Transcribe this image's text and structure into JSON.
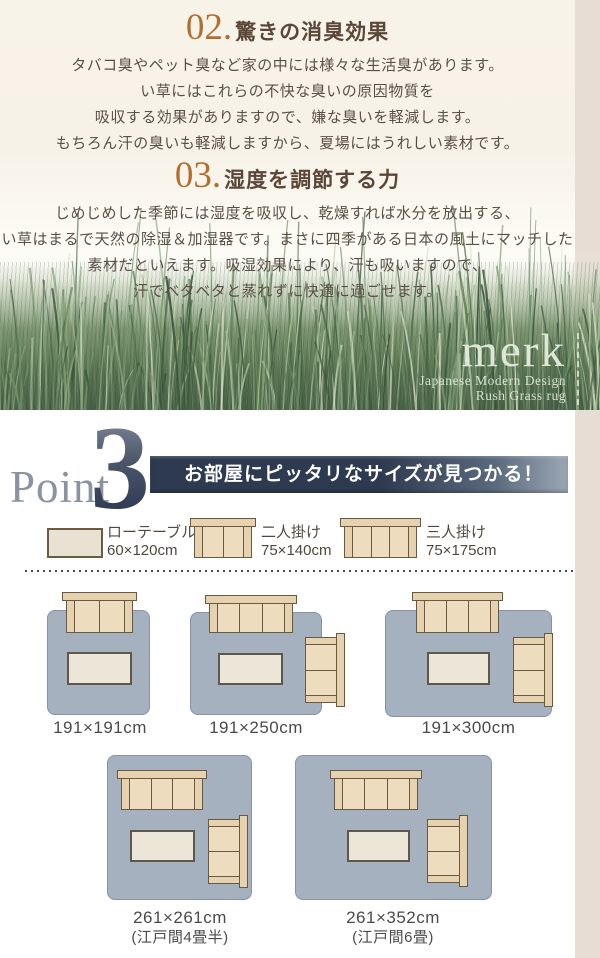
{
  "sections": {
    "deodorize": {
      "number": "02.",
      "title": "驚きの消臭効果",
      "lines": [
        "タバコ臭やペット臭など家の中には様々な生活臭があります。",
        "い草にはこれらの不快な臭いの原因物質を",
        "吸収する効果がありますので、嫌な臭いを軽減します。",
        "もちろん汗の臭いも軽減しますから、夏場にはうれしい素材です。"
      ]
    },
    "humidity": {
      "number": "03.",
      "title": "湿度を調節する力",
      "lines": [
        "じめじめした季節には湿度を吸収し、乾燥すれば水分を放出する、",
        "い草はまるで天然の除湿＆加湿器です。まさに四季がある日本の風土にマッチした",
        "素材だといえます。吸湿効果により、汗も吸いますので、",
        "汗でベタベタと蒸れずに快適に過ごせます。"
      ]
    }
  },
  "brand": {
    "name": "merk",
    "tagline1": "Japanese Modern Design",
    "tagline2": "Rush Grass rug"
  },
  "point": {
    "word": "Point",
    "number": "3",
    "banner": "お部屋にピッタリなサイズが見つかる！"
  },
  "legend": [
    {
      "type": "low-table",
      "label": "ローテーブル",
      "size": "60×120cm"
    },
    {
      "type": "sofa-2seat",
      "label": "二人掛け",
      "size": "75×140cm"
    },
    {
      "type": "sofa-3seat",
      "label": "三人掛け",
      "size": "75×175cm"
    }
  ],
  "rugs": [
    {
      "size": "191×191cm",
      "note": ""
    },
    {
      "size": "191×250cm",
      "note": ""
    },
    {
      "size": "191×300cm",
      "note": ""
    },
    {
      "size": "261×261cm",
      "note": "(江戸間4畳半)"
    },
    {
      "size": "261×352cm",
      "note": "(江戸間6畳)"
    }
  ],
  "colors": {
    "accent_orange": "#b06f2e",
    "heading_brown": "#5b4738",
    "banner_navy": "#2d3a4f",
    "rug_blue": "#a6b1c0",
    "sofa_beige": "#eedcbe",
    "strip_beige": "#e7ddd5"
  }
}
